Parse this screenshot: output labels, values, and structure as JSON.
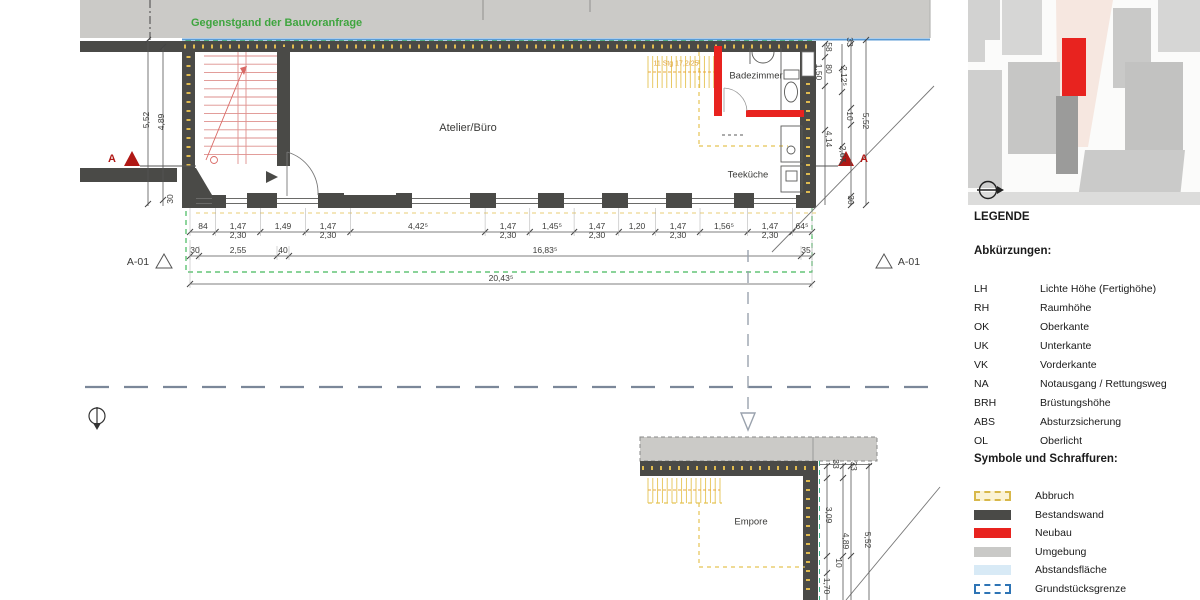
{
  "note": {
    "text": "Gegenstgand der Bauvoranfrage"
  },
  "rooms": {
    "atelier": "Atelier/Büro",
    "badezimmer": "Badezimmer",
    "teekueche": "Teeküche",
    "empore": "Empore"
  },
  "stair_note": "11 Stg 17,2/25",
  "section_markers": {
    "a_left": "A",
    "a_right": "A",
    "a01_left": "A-01",
    "a01_right": "A-01"
  },
  "dimensions": {
    "bottom_row1": [
      {
        "label": "84"
      },
      {
        "label": "1,47",
        "sub": "2,30"
      },
      {
        "label": "1,49"
      },
      {
        "label": "1,47",
        "sub": "2,30"
      },
      {
        "label": "4,42⁵"
      },
      {
        "label": "1,47",
        "sub": "2,30"
      },
      {
        "label": "1,45⁵"
      },
      {
        "label": "1,47",
        "sub": "2,30"
      },
      {
        "label": "1,20"
      },
      {
        "label": "1,47",
        "sub": "2,30"
      },
      {
        "label": "1,56⁵"
      },
      {
        "label": "1,47",
        "sub": "2,30"
      },
      {
        "label": "64⁵"
      }
    ],
    "bottom_row2": [
      {
        "label": "30"
      },
      {
        "label": "2,55"
      },
      {
        "label": "40"
      },
      {
        "label": "16,83⁵"
      },
      {
        "label": "35"
      }
    ],
    "bottom_total": [
      {
        "label": "20,43⁵"
      }
    ],
    "left_column": [
      {
        "label": "5,52"
      },
      {
        "label": "4,89"
      },
      {
        "label": "30"
      }
    ],
    "right_column_upper": [
      {
        "label": "33"
      },
      {
        "label": "58"
      },
      {
        "label": "80"
      },
      {
        "label": "1,50"
      },
      {
        "label": "2,12⁵"
      },
      {
        "label": "10"
      },
      {
        "label": "5,52"
      },
      {
        "label": "4,14"
      },
      {
        "label": "2,67"
      },
      {
        "label": "30"
      }
    ],
    "right_column_lower": [
      {
        "label": "33"
      },
      {
        "label": "33"
      },
      {
        "label": "3,09"
      },
      {
        "label": "4,89"
      },
      {
        "label": "5,52"
      },
      {
        "label": "10"
      },
      {
        "label": "1,70"
      }
    ]
  },
  "legend": {
    "title": "LEGENDE",
    "abbr_title": "Abkürzungen:",
    "abbreviations": [
      {
        "abbr": "LH",
        "term": "Lichte Höhe (Fertighöhe)"
      },
      {
        "abbr": "RH",
        "term": "Raumhöhe"
      },
      {
        "abbr": "OK",
        "term": "Oberkante"
      },
      {
        "abbr": "UK",
        "term": "Unterkante"
      },
      {
        "abbr": "VK",
        "term": "Vorderkante"
      },
      {
        "abbr": "NA",
        "term": "Notausgang / Rettungsweg"
      },
      {
        "abbr": "BRH",
        "term": "Brüstungshöhe"
      },
      {
        "abbr": "ABS",
        "term": "Absturzsicherung"
      },
      {
        "abbr": "OL",
        "term": "Oberlicht"
      }
    ],
    "symbols_title": "Symbole und Schraffuren:",
    "symbols": [
      {
        "label": "Abbruch",
        "type": "abbruch"
      },
      {
        "label": "Bestandswand",
        "type": "bestandswand"
      },
      {
        "label": "Neubau",
        "type": "neubau"
      },
      {
        "label": "Umgebung",
        "type": "umgebung"
      },
      {
        "label": "Abstandsfläche",
        "type": "abstandsflaeche"
      },
      {
        "label": "Grundstücksgrenze",
        "type": "grundstuecksgrenze"
      }
    ]
  },
  "colors": {
    "neubau_red": "#e8231f",
    "bestand_dark": "#4a4a47",
    "umgebung_gray": "#cbcac7",
    "abbruch_yellow": "#e0bb50",
    "abstand_blue": "#d8eaf6",
    "grenze_blue": "#2e74b5",
    "boundary_green": "#43b95c",
    "note_green": "#3fa53f"
  }
}
